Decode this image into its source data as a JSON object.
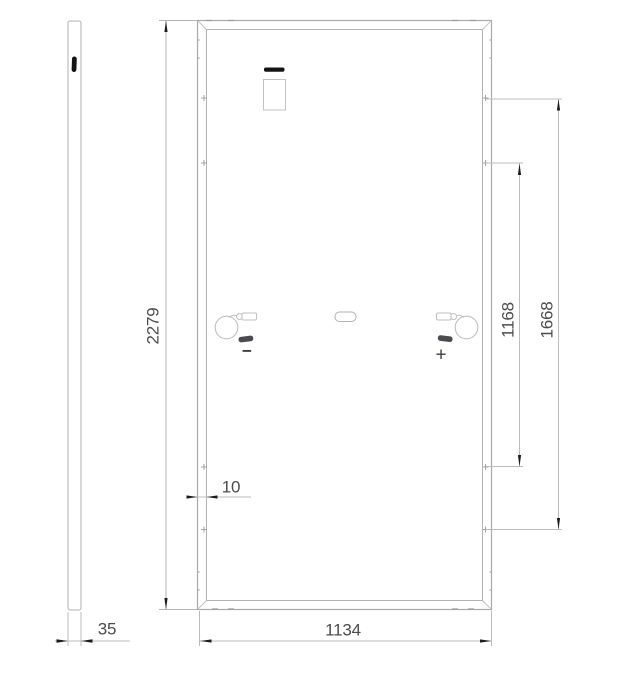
{
  "drawing": {
    "subject": "panel rear view with side profile",
    "colors": {
      "line": "#b2b2b7",
      "line_light": "#c2c2c6",
      "arrow_dark": "#1c1c1e",
      "label_text": "#4c4c50",
      "background": "#ffffff"
    },
    "icons": {
      "junction_box": "rect-outline",
      "junction_box_cover": "black-bar",
      "cable_coil": "circle-outline",
      "connector": "rounded-rect",
      "mounting_hole": "plus-mark",
      "grounding_slot": "stadium-outline"
    }
  },
  "dimensions": {
    "height": {
      "value": "2279",
      "orientation": "vertical"
    },
    "width": {
      "value": "1134",
      "orientation": "horizontal"
    },
    "thickness": {
      "value": "35",
      "orientation": "horizontal"
    },
    "frame_edge": {
      "value": "10",
      "orientation": "horizontal"
    },
    "mounting_span_inner": {
      "value": "1168",
      "orientation": "vertical"
    },
    "mounting_span_outer": {
      "value": "1668",
      "orientation": "vertical"
    }
  },
  "polarity": {
    "negative": "−",
    "positive": "+"
  }
}
